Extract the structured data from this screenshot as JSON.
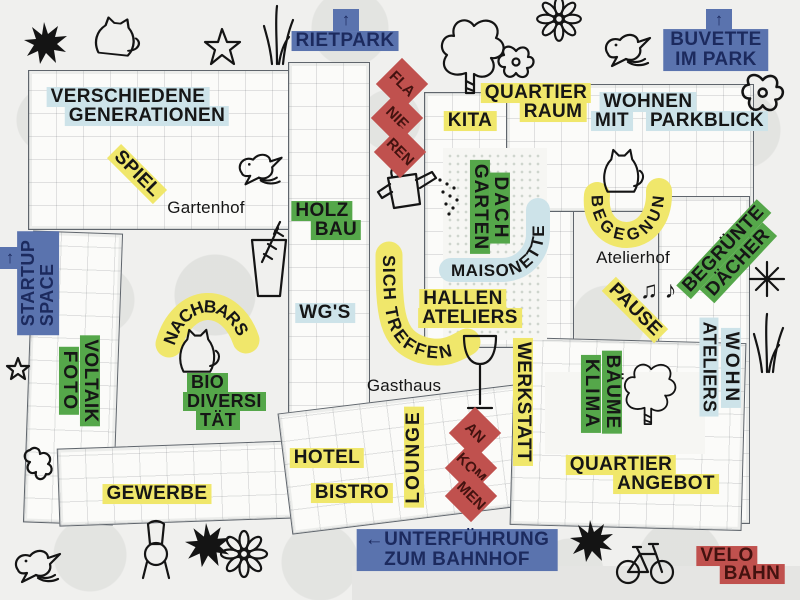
{
  "palette": {
    "yellow": "#f0e76b",
    "green": "#55a74a",
    "light_blue": "#cde3e9",
    "blue": "#5a73ae",
    "blue_text": "#1c2a5e",
    "red": "#c0514e",
    "red_text": "#43120f",
    "ink": "#161616",
    "paper": "#f0f0ee",
    "plan_line": "#5f656c"
  },
  "signs": {
    "rietpark": {
      "arrow": "↑",
      "label": "RIETPARK"
    },
    "buvette": {
      "arrow": "↑",
      "lines": [
        "BUVETTE",
        "IM PARK"
      ]
    },
    "startup": {
      "arrow": "↑",
      "lines": [
        "STARTUP",
        "SPACE"
      ]
    },
    "unterfuehrung": {
      "lines": [
        "←UNTERFÜHRUNG",
        "ZUM BAHNHOF"
      ]
    },
    "velobahn": {
      "lines": [
        "VELO",
        "BAHN"
      ]
    },
    "flanieren": {
      "syllables": [
        "FLA",
        "NIE",
        "REN"
      ]
    },
    "ankommen": {
      "syllables": [
        "AN",
        "KOM",
        "MEN"
      ]
    }
  },
  "areas": {
    "verschiedene_generationen": {
      "lines": [
        "VERSCHIEDENE",
        "GENERATIONEN"
      ]
    },
    "wohnen_mit_parkblick": {
      "line1": "WOHNEN",
      "line2a": "MIT",
      "line2b": "PARKBLICK"
    },
    "quartier_raum": {
      "lines": [
        "QUARTIER",
        "RAUM"
      ]
    },
    "kita": "KITA",
    "spiel": "SPIEL",
    "holzbau": {
      "lines": [
        "HOLZ",
        "BAU"
      ]
    },
    "wgs": "WG'S",
    "nachbarschaft": "NACHBARSCHAFT",
    "biodiversitaet": {
      "lines": [
        "BIO",
        "DIVERSI",
        "TÄT"
      ]
    },
    "foto_voltaik": {
      "lines": [
        "FOTO",
        "VOLTAIK"
      ]
    },
    "dachgarten": {
      "lines": [
        "DACH",
        "GARTEN"
      ]
    },
    "maisonette": "MAISONETTE",
    "sich_treffen": "SICH TREFFEN",
    "hallen_ateliers": {
      "lines": [
        "HALLEN",
        "ATELIERS"
      ]
    },
    "begegnung": "BEGEGNUNG",
    "pause": "PAUSE",
    "begruente_daecher": {
      "lines": [
        "BEGRÜNTE",
        "DÄCHER"
      ]
    },
    "wohn_ateliers": {
      "lines": [
        "WOHN",
        "ATELIERS"
      ]
    },
    "werkstatt": "WERKSTATT",
    "klima_baeume": {
      "lines": [
        "KLIMA",
        "BÄUME"
      ]
    },
    "quartier_angebot": {
      "lines": [
        "QUARTIER",
        "ANGEBOT"
      ]
    },
    "hotel": "HOTEL",
    "bistro": "BISTRO",
    "lounge": "LOUNGE",
    "gewerbe": "GEWERBE"
  },
  "places": {
    "gartenhof": "Gartenhof",
    "gasthaus": "Gasthaus",
    "atelierhof": "Atelierhof"
  },
  "decor_glyphs": {
    "music_notes": "♫ ♪"
  }
}
